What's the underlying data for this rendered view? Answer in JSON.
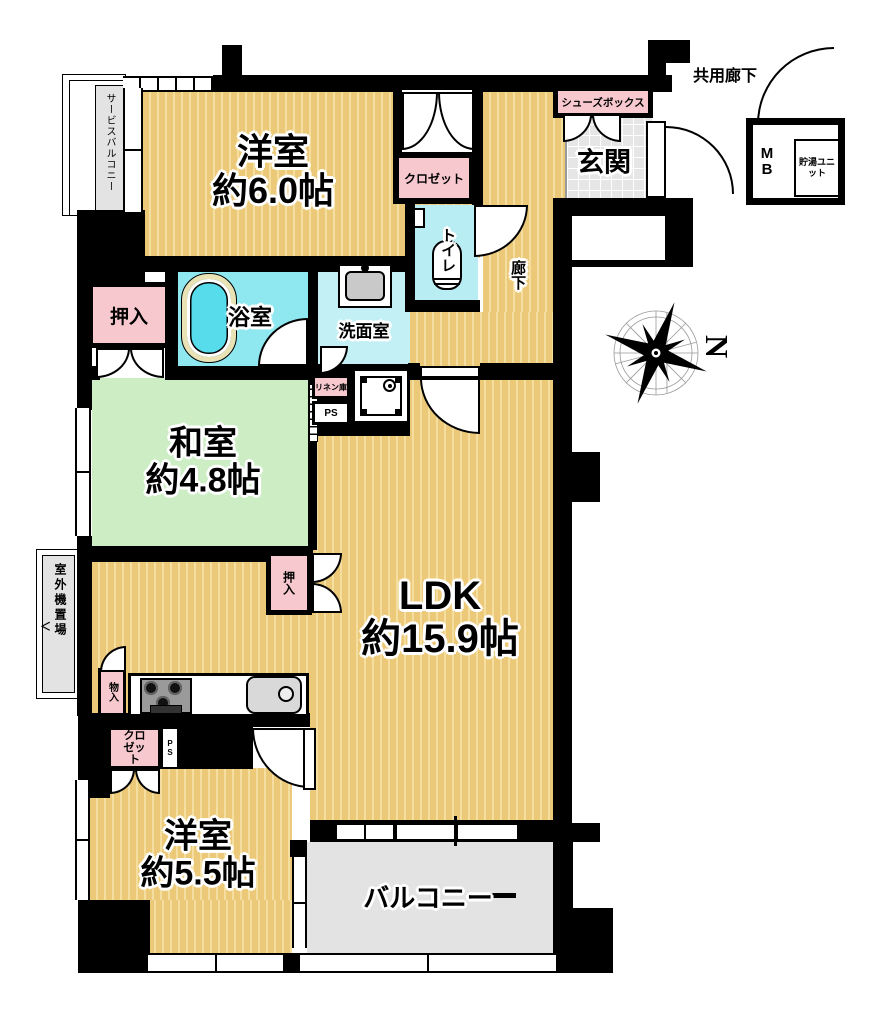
{
  "labels": {
    "yoshitsu6_name": "洋室",
    "yoshitsu6_size": "約6.0帖",
    "washitsu_name": "和室",
    "washitsu_size": "約4.8帖",
    "ldk_name": "LDK",
    "ldk_size": "約15.9帖",
    "yoshitsu55_name": "洋室",
    "yoshitsu55_size": "約5.5帖",
    "balcony": "バルコニー",
    "genkan": "玄関",
    "bath": "浴室",
    "washroom": "洗面室",
    "toilet": "トイレ",
    "hallway": "廊下",
    "common_corridor": "共用廊下",
    "service_balcony": "サービスバルコニー",
    "outdoor_unit": "室外機置場",
    "outdoor_unit_arrow": "＜",
    "shoes_box": "シューズボックス",
    "closet_north": "クロゼット",
    "closet_south": "クロゼット",
    "oshiire_north": "押入",
    "oshiire_ldk": "押入",
    "storage": "物入",
    "linen": "リネン庫",
    "ps_north": "PS",
    "ps_south": "PS",
    "mb": "MB",
    "hot_water_unit": "貯湯ユニット",
    "compass_north": "N"
  },
  "colors": {
    "wall": "#000000",
    "wood_floor": "#ecc979",
    "wood_stripe": "#f4dfa0",
    "tatami": "#cdeec5",
    "bath": "#8fe7ef",
    "washroom": "#c3f0f4",
    "toilet": "#b9edf4",
    "label_pink": "#f7c9ce",
    "tile_gray": "#e3e3e3"
  }
}
